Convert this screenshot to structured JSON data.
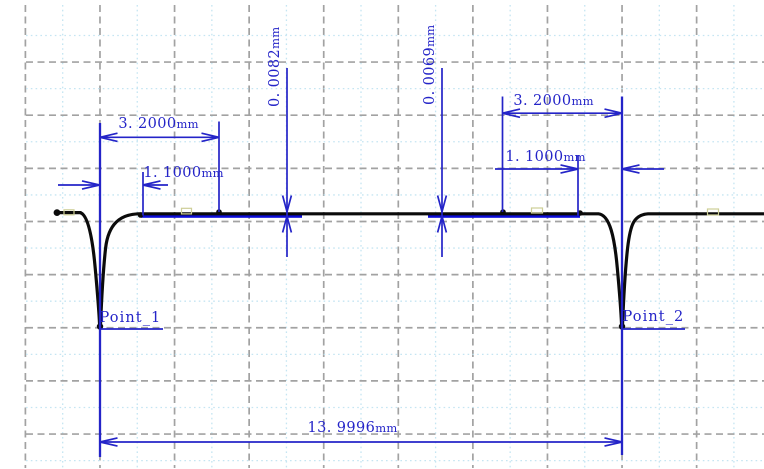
{
  "dimensions": {
    "left_width": {
      "value": "3. 2000",
      "unit": "mm"
    },
    "left_offset": {
      "value": "1. 1000",
      "unit": "mm"
    },
    "left_depth": {
      "value": "0. 0082",
      "unit": "mm"
    },
    "right_depth": {
      "value": "0. 0069",
      "unit": "mm"
    },
    "right_width": {
      "value": "3. 2000",
      "unit": "mm"
    },
    "right_offset": {
      "value": "1. 1000",
      "unit": "mm"
    },
    "total_width": {
      "value": "13. 9996",
      "unit": "mm"
    }
  },
  "points": {
    "point1": {
      "label": "Point_1"
    },
    "point2": {
      "label": "Point_2"
    }
  },
  "colors": {
    "dimension": "#2424c8",
    "zone": "#0d0dd8",
    "profile": "#0b0b0b",
    "grid_major": "#a2a2a2",
    "grid_minor": "#c5e5f2",
    "marker": "#cdce97",
    "background": "#ffffff"
  }
}
